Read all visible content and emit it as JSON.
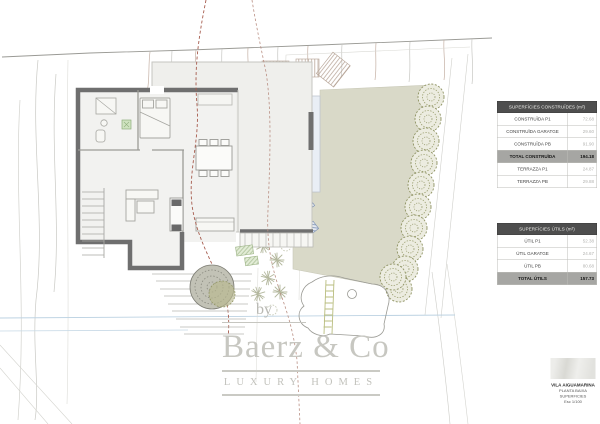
{
  "tables": {
    "constructed": {
      "header": "SUPERFÍCIES CONSTRUÏDES (m²)",
      "rows": [
        {
          "label": "CONSTRUÏDA P1",
          "value": "72.68",
          "total": false
        },
        {
          "label": "CONSTRUÏDA GARATGE",
          "value": "29.60",
          "total": false
        },
        {
          "label": "CONSTRUÏDA PB",
          "value": "91.90",
          "total": false
        },
        {
          "label": "TOTAL CONSTRUÏDA",
          "value": "194.18",
          "total": true
        },
        {
          "label": "TERRAZZA P1",
          "value": "24.87",
          "total": false
        },
        {
          "label": "TERRAZZA PB",
          "value": "29.88",
          "total": false
        }
      ]
    },
    "useful": {
      "header": "SUPERFÍCIES ÚTILS (m²)",
      "rows": [
        {
          "label": "ÚTIL P1",
          "value": "52.38",
          "total": false
        },
        {
          "label": "ÚTIL GARATGE",
          "value": "24.67",
          "total": false
        },
        {
          "label": "ÚTIL PB",
          "value": "80.68",
          "total": false
        },
        {
          "label": "TOTAL ÚTILS",
          "value": "157.73",
          "total": true
        }
      ]
    }
  },
  "watermark": {
    "by": "by",
    "brand": "Baerz & Co",
    "tagline": "LUXURY HOMES"
  },
  "titleblock": {
    "project": "VILA AIGUAMARINA",
    "line2": "PLANTA BAIXA",
    "line3": "SUPERFICIES",
    "line4": "Esc 1/100"
  },
  "colors": {
    "lawn": "#d9d9c8",
    "pool": "#e9eef5",
    "wall": "#6f6f6f",
    "tree_stroke": "#8f9363",
    "section_line": "#a65c4e",
    "water_line": "#bcd2e2"
  }
}
